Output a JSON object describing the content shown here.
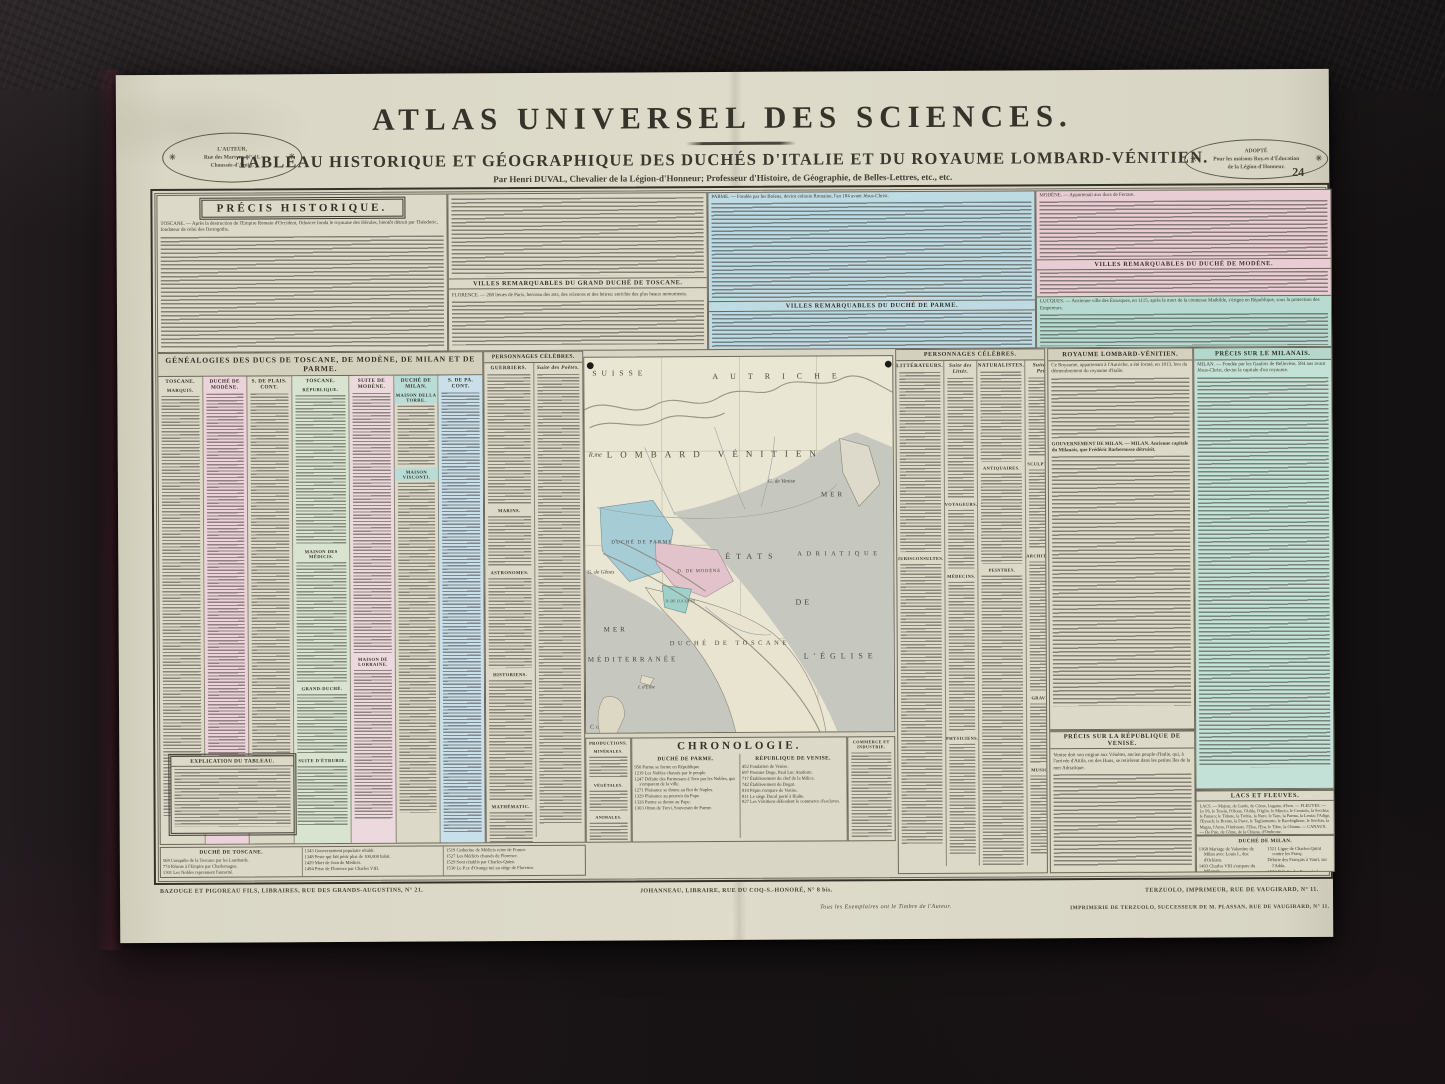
{
  "colors": {
    "paper": "#dad7c6",
    "parme_blue": "#bedae3",
    "modene_pink": "#e8cdd4",
    "lucques_teal": "#b7dbd1",
    "milan_teal": "#c3e1d6",
    "gene_pink": "#ecd3da",
    "gene_green": "#d9e4d0",
    "gene_blue": "#c9dfe9",
    "sea_gray": "#c6c8c0"
  },
  "sheet": {
    "page_number": "24",
    "title": "ATLAS UNIVERSEL DES SCIENCES.",
    "subtitle": "TABLEAU HISTORIQUE ET GÉOGRAPHIQUE DES DUCHÉS D'ITALIE ET DU ROYAUME LOMBARD-VÉNITIEN.",
    "byline": "Par Henri DUVAL, Chevalier de la Légion-d'Honneur; Professeur d'Histoire, de Géographie, de Belles-Lettres, etc., etc."
  },
  "stamps": {
    "left": {
      "line1": "L'AUTEUR,",
      "line2": "Rue des Martyrs, N° 31,",
      "line3": "Chaussée-d'Antin.",
      "ornament": "✳"
    },
    "right": {
      "line1": "ADOPTÉ",
      "line2": "Pour les maisons Roy.es d'Éducation",
      "line3": "de la Légion-d'Honneur.",
      "ornament": "✳"
    }
  },
  "top_sections": {
    "precis_title": "PRÉCIS HISTORIQUE.",
    "precis_lead": "TOSCANE. — Après la destruction de l'Empire Romain d'Occident, Odoacre fonda le royaume des Hérules, bientôt détruit par Théodoric, fondateur de celui des Ostrogoths.",
    "villes_toscane_title": "VILLES REMARQUABLES DU GRAND DUCHÉ DE TOSCANE.",
    "florence_lead": "FLORENCE. — 268 lieues de Paris, berceau des arts, des sciences et des lettres; enrichie des plus beaux monuments.",
    "parme_lead": "PARME. — Fondée par les Boïens, devint colonie Romaine, l'an 184 avant Jésus-Christ.",
    "villes_parme_title": "VILLES REMARQUABLES DU DUCHÉ DE PARME.",
    "modene_lead": "MODÈNE. — Appartenait aux ducs de Ferrare.",
    "villes_modene_title": "VILLES REMARQUABLES DU DUCHÉ DE MODÈNE.",
    "lucques_lead": "LUCQUES. — Ancienne ville des Étrusques, en 1115, après la mort de la comtesse Mathilde, s'érigea en République, sous la protection des Empereurs."
  },
  "genealogy": {
    "title": "GÉNÉALOGIES DES DUCS DE TOSCANE, DE MODÈNE, DE MILAN ET DE PARME.",
    "columns": [
      "TOSCANE.",
      "DUCHÉ DE MODÈNE.",
      "S. DE PLAIS. CONT.",
      "TOSCANE.",
      "SUITE DE MODÈNE.",
      "DUCHÉ DE MILAN.",
      "S. DE PA. CONT."
    ],
    "sub_marquis": "MARQUIS.",
    "sub_republique": "RÉPUBLIQUE.",
    "sub_medicis": "MAISON DES MÉDICIS.",
    "sub_grand_duche": "GRAND-DUCHÉ.",
    "sub_etrurie": "SUITE D'ÉTRURIE.",
    "sub_lorraine": "MAISON DE LORRAINE.",
    "sub_della_torre": "MAISON DELLA TORRE.",
    "sub_visconti": "MAISON VISCONTI.",
    "explication_title": "EXPLICATION DU TABLEAU."
  },
  "personnages_left": {
    "title": "PERSONNAGES CÉLÈBRES.",
    "col1_header": "GUERRIERS.",
    "col2_header": "Suite des Poëtes.",
    "sub_marins": "MARINS.",
    "sub_astronomes": "ASTRONOMES.",
    "sub_historiens": "HISTORIENS.",
    "sub_mathematic": "MATHÉMATIC."
  },
  "personnages_right": {
    "title": "PERSONNAGES CÉLÈBRES.",
    "col1_header": "LITTÉRATEURS.",
    "col2_header": "Suite des Littér.",
    "col3_header": "NATURALISTES.",
    "col4_header": "Suite des Peint.",
    "sub_jurisconsultes": "JURISCONSULTES.",
    "sub_voyageurs": "VOYAGEURS.",
    "sub_medecins": "MÉDECINS.",
    "sub_physiciens": "PHYSICIENS.",
    "sub_antiquaires": "ANTIQUAIRES.",
    "sub_peintres": "PEINTRES.",
    "sub_sculpteurs": "SCULPTEURS.",
    "sub_architectes": "ARCHITECTES.",
    "sub_graveurs": "GRAVEURS.",
    "sub_musiciens": "MUSICIENS."
  },
  "royaume": {
    "title": "ROYAUME LOMBARD-VÉNITIEN.",
    "lead": "Ce Royaume, appartenant à l'Autriche, a été formé, en 1813, lors du démembrement du royaume d'Italie.",
    "gouvernement": "GOUVERNEMENT DE MILAN. — MILAN. Ancienne capitale du Milanais, que Frédéric Barberousse détruisit."
  },
  "milanais": {
    "title": "PRÉCIS SUR LE MILANAIS.",
    "lead": "MILAN. — Fondée par les Gaulois de Bellovèse, 584 ans avant Jésus-Christ, devint la capitale d'un royaume."
  },
  "chronologie": {
    "title": "CHRONOLOGIE.",
    "parme_title": "DUCHÉ DE PARME.",
    "parme_entries": [
      "950 Parme se forme en République.",
      "1219 Les Nobles chassés par le peuple.",
      "1247 Défaite des Parmesans à Toro par les Nobles, qui s'emparent de la ville.",
      "1271 Plaisance se donne au Roi de Naples.",
      "1329 Plaisance au pouvoir du Pape.",
      "1326 Parme se donne au Pape.",
      "1303 Otton de Trevi, Souverain de Parme."
    ],
    "venise_title": "RÉPUBLIQUE DE VENISE.",
    "venise_entries": [
      "452 Fondation de Venise.",
      "697 Premier Doge, Paul Luc Anafeste.",
      "717 Établissement du chef de la Milice.",
      "742 Établissement du Dogat.",
      "810 Pépin s'empare de Venise.",
      "811 Le siège Ducal porté à Rialte.",
      "827 Les Vénitiens défendent le commerce d'esclaves."
    ]
  },
  "productions": {
    "title": "PRODUCTIONS.",
    "sub1": "MINÉRALES.",
    "sub2": "VÉGÉTALES.",
    "sub3": "ANIMALES."
  },
  "commerce": {
    "title": "COMMERCE ET INDUSTRIE."
  },
  "duche_toscane": {
    "title": "DUCHÉ DE TOSCANE.",
    "entries": [
      "568 Conquête de la Toscane par les Lombards.",
      "774 Réunie à l'Empire par Charlemagne.",
      "1301 Les Nobles reprennent l'autorité.",
      "1315 Guerre contre Pise.",
      "1343 Gouvernement populaire rétabli.",
      "1348 Peste qui fait périr plus de 100,000 habit.",
      "1429 Mort de Jean de Médicis.",
      "1494 Prise de Florence par Charles VIII.",
      "1519 Catherine de Médicis reine de France.",
      "1527 Les Médicis chassés de Florence.",
      "1529 Sont rétablis par Charles-Quint.",
      "1530 Le P.ce d'Orange tué au siège de Florence."
    ]
  },
  "venise_precis": {
    "title": "PRÉCIS SUR LA RÉPUBLIQUE DE VENISE.",
    "lead": "Venise doit son origine aux Vénètes, ancien peuple d'Italie, qui, à l'arrivée d'Attila, roi des Huns, se retirèrent dans les petites îles de la mer Adriatique."
  },
  "lacs": {
    "title": "LACS ET FLEUVES.",
    "text": "LACS. — Majeur, de Garde, de Côme, Lugano, d'Iseo. — FLEUVES. — Le Pô, le Tessin, l'Olona, l'Adda, l'Oglio, le Mincio, le Crostolo, la Secchia; le Panaro; le Tidone, la Trebia, la Nure, le Taro, la Parma, la Lenza; l'Adige, l'Eysach; la Brenta, la Piave, le Tagliamento, le Bacchiglione, le Serchio, la Magra, l'Arno, l'Ombrone, l'Elsa, l'Era, le Tibre, la Chiana. — CANAUX. — De Pise, de Côme, de la Chiana, d'Ombrone."
  },
  "duche_milan": {
    "title": "DUCHÉ DE MILAN.",
    "entries": [
      "1368 Mariage de Valentine de Milan avec Louis I., duc d'Orléans.",
      "1493 Charles VIII s'empare du Milanais.",
      "1500 Louis XII, maître du Milanais.",
      "1515 François I. s'empare du Milanais.",
      "1521 Ligue de Charles-Quint contre les Franç.",
      "Défaite des Français à Vauri, sur l'Adda.",
      "1522 Défaite des Français à Rebec.",
      "Mort de Bayard.",
      "Les Impériaux prennent Milan.",
      "1540 L'Empereur donne le Milanais à son fils Philippe."
    ]
  },
  "map": {
    "labels": {
      "suisse": "SUISSE",
      "autriche": "AUTRICHE",
      "rme": "R.me",
      "lombard": "LOMBARD  VÉNITIEN",
      "g_venise": "G. de Venise",
      "mer": "MER",
      "adriatique": "ADRIATIQUE",
      "etats": "ÉTATS",
      "de": "DE",
      "eglise": "L'ÉGLISE",
      "parme": "DUCHÉ DE PARME",
      "modene": "D. DE MODÈNE",
      "lucques": "D. DE LUCQUES",
      "toscane": "DUCHÉ DE TOSCANE",
      "g_genes": "G. de Gênes",
      "mer2": "MER",
      "mediterranee": "MÉDITERRANÉE",
      "elbe": "I. d'Elbe",
      "corse": "Corse"
    }
  },
  "imprint": {
    "left": "BAZOUGE ET PIGOREAU FILS, LIBRAIRES, RUE DES GRANDS-AUGUSTINS, N° 21.",
    "center": "JOHANNEAU, LIBRAIRE, RUE DU COQ-S.-HONORÉ, N° 8 bis.",
    "right": "TERZUOLO, IMPRIMEUR, RUE DE VAUGIRARD, N° 11.",
    "note": "Tous les Exemplaires ont le Timbre de l'Auteur.",
    "printer": "IMPRIMERIE DE TERZUOLO, SUCCESSEUR DE M. PLASSAN, RUE DE VAUGIRARD, N° 11."
  }
}
